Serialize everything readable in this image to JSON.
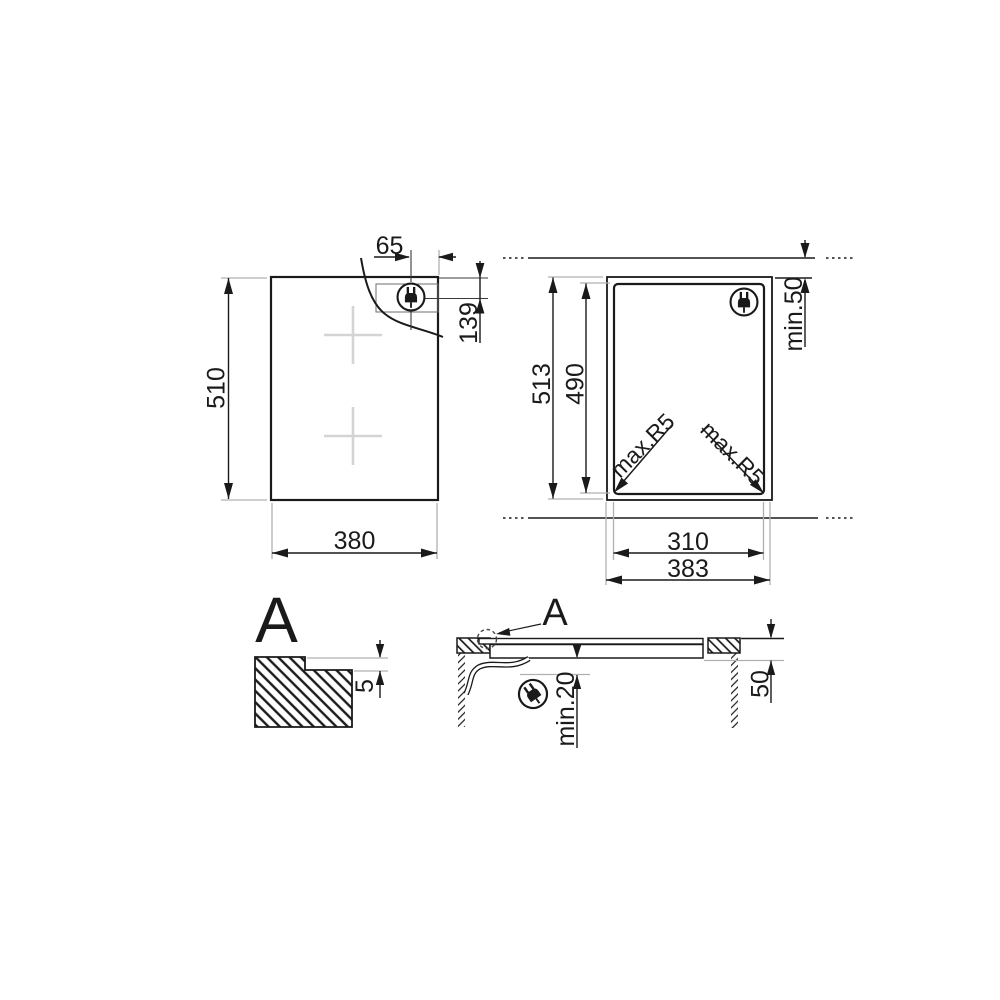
{
  "drawing": {
    "type": "appliance installation diagram",
    "colors": {
      "line": "#1a1a1a",
      "extension_line": "#b0b0b0",
      "hob_marking": "#d4d4d4",
      "background": "#ffffff"
    },
    "plan_view": {
      "height": "510",
      "width": "380",
      "plug_offset_top": "65",
      "plug_offset_side": "139",
      "plug_icon": "power-plug-icon"
    },
    "cutout_view": {
      "outer_height": "513",
      "inner_height": "490",
      "wall_clearance": "min.50",
      "corner_radius_left": "max.R5",
      "corner_radius_right": "max.R5",
      "inner_width": "310",
      "outer_width": "383",
      "plug_icon": "power-plug-icon"
    },
    "detail_view": {
      "label": "A",
      "step_depth": "5"
    },
    "section_view": {
      "label": "A",
      "clearance_below": "min.20",
      "recess_depth": "50",
      "plug_icon": "power-plug-icon"
    }
  }
}
